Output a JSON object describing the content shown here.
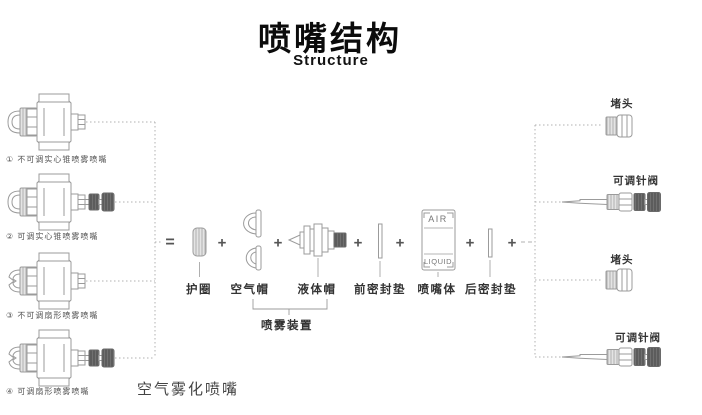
{
  "title": {
    "zh": "喷嘴结构",
    "en": "Structure"
  },
  "operators": {
    "equals": "=",
    "plus": "+"
  },
  "left_nozzles": [
    {
      "label": "① 不可调实心锥喷雾喷嘴"
    },
    {
      "label": "② 可调实心锥喷雾喷嘴"
    },
    {
      "label": "③ 不可调扇形喷雾喷嘴"
    },
    {
      "label": "④ 可调扇形喷雾喷嘴"
    }
  ],
  "exploded": {
    "parts": [
      {
        "label": "护圈"
      },
      {
        "label": "空气帽"
      },
      {
        "label": "液体帽"
      },
      {
        "label": "前密封垫"
      },
      {
        "label": "喷嘴体",
        "markings": {
          "top": "AIR",
          "bottom": "LIQUID"
        }
      },
      {
        "label": "后密封垫"
      }
    ],
    "group_label": "喷雾装置"
  },
  "right_parts": [
    {
      "label": "堵头"
    },
    {
      "label": "可调针阀"
    },
    {
      "label": "堵头"
    },
    {
      "label": "可调针阀"
    }
  ],
  "bottom_label": "空气雾化喷嘴",
  "colors": {
    "line": "#9b9b9b",
    "dark_part": "#5c5c5c",
    "text": "#3c3c3c"
  }
}
